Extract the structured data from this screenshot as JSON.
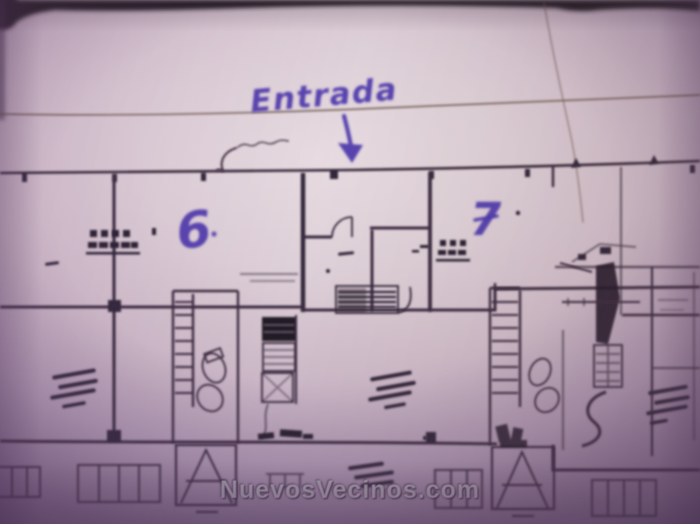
{
  "photo": {
    "watermark": "NuevosVecinos.com"
  },
  "annotations": {
    "entrance_label": "Entrada",
    "unit_left_number": "6",
    "unit_right_number": "7"
  },
  "colors": {
    "handwriting_ink": "#4c38ac",
    "plan_line": "#3a2c3f",
    "paper": "#d9cbd4",
    "photo_edge": "#241a20",
    "watermark_text": "#e7e0ec"
  }
}
